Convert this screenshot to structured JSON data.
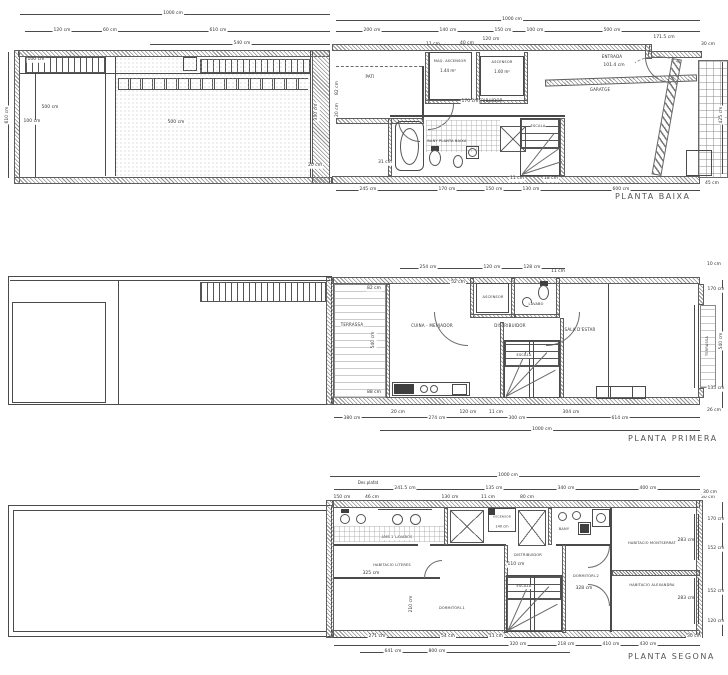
{
  "colors": {
    "line": "#4a4a4a",
    "hatch": "#8f8f8f",
    "text": "#333333",
    "background": "#ffffff"
  },
  "plan1": {
    "title": "PLANTA BAIXA",
    "rooms": {
      "pati": "PATI",
      "maq": "MAQ. ASCENSOR",
      "maq_area": "1.44 m²",
      "asc": "ASCENSOR",
      "asc_area": "1.60 m²",
      "dist": "DISTRIBUIDOR",
      "bany": "BANY PLANTA BAIXA",
      "escala": "ESCALA",
      "garatge": "GARATGE",
      "entrada": "ENTRADA"
    },
    "dims": {
      "d1": "1000 cm",
      "d2": "1000 cm",
      "d3": "120 cm",
      "d4": "60 cm",
      "d5": "610 cm",
      "d6": "540 cm",
      "d7": "200 cm",
      "d8": "140 cm",
      "d9": "150 cm",
      "d10": "100 cm",
      "d11": "500 cm",
      "d12": "171.5 cm",
      "d13": "610 cm",
      "d14": "500 cm",
      "d15": "100 cm",
      "d16": "100 cm",
      "d17": "500 cm",
      "d18": "330 cm",
      "d19": "20 cm",
      "d20": "82 cm",
      "d21": "20 cm",
      "d22": "245 cm",
      "d23": "170 cm",
      "d24": "150 cm",
      "d25": "130 cm",
      "d26": "600 cm",
      "d27": "30 cm",
      "d28": "425 cm",
      "d29": "45 cm",
      "d30": "170 cm",
      "d31": "11 cm",
      "d32": "40 cm",
      "d33": "120 cm",
      "d34": "101.4 cm",
      "d35": "31 cm",
      "d36": "11 cm",
      "d37": "18 cm"
    }
  },
  "plan2": {
    "title": "PLANTA PRIMERA",
    "rooms": {
      "terrassa": "TERRASSA",
      "cuina": "CUINA - MENJADOR",
      "ascensor": "ASCENSOR",
      "lavabo": "LAVABO",
      "dist": "DISTRIBUIDOR",
      "escala": "ESCALA",
      "sala": "SALA D'ESTAR",
      "balco": "TERRASSA"
    },
    "dims": {
      "d1": "254 cm",
      "d2": "120 cm",
      "d3": "128 cm",
      "d4": "11 cm",
      "d5": "10 cm",
      "d6": "52 cm",
      "d7": "82 cm",
      "d8": "540 cm",
      "d9": "88 cm",
      "d10": "170 cm",
      "d11": "540 cm",
      "d12": "135 cm",
      "d13": "26 cm",
      "d14": "20 cm",
      "d15": "120 cm",
      "d16": "11 cm",
      "d17": "304 cm",
      "d18": "380 cm",
      "d19": "274 cm",
      "d20": "300 cm",
      "d21": "614 cm",
      "d22": "1000 cm"
    }
  },
  "plan3": {
    "title": "PLANTA SEGONA",
    "rooms": {
      "bany1": "AMB 2 LAVABOS",
      "ascensor": "ASCENSOR",
      "bany2": "BANY",
      "dist": "DISTRIBUIDOR",
      "escala": "ESCALA",
      "literes": "HABITACIO LITERES",
      "dorm1": "DORMITORI-1",
      "dorm2": "DORMITORI-2",
      "montserrat": "HABITACIO MONTSERRAT",
      "alexandra": "HABITACIO ALEXANDRA"
    },
    "annotations": {
      "a1": "Des plafat"
    },
    "dims": {
      "d1": "1000 cm",
      "d2": "241.5 cm",
      "d3": "135 cm",
      "d4": "340 cm",
      "d5": "400 cm",
      "d6": "150 cm",
      "d7": "46 cm",
      "d8": "130 cm",
      "d9": "80 cm",
      "d10": "30 cm",
      "d11": "11 cm",
      "d12": "30 cm",
      "d13": "170 cm",
      "d14": "152 cm",
      "d15": "152 cm",
      "d16": "120 cm",
      "d17": "283 cm",
      "d18": "283 cm",
      "d19": "328 cm",
      "d20": "110 cm",
      "d21": "140 cm",
      "d22": "325 cm",
      "d23": "210 cm",
      "d24": "271 cm",
      "d25": "54 cm",
      "d26": "11 cm",
      "d27": "30 cm",
      "d28": "320 cm",
      "d29": "218 cm",
      "d30": "410 cm",
      "d31": "430 cm",
      "d32": "641 cm",
      "d33": "800 cm"
    }
  }
}
